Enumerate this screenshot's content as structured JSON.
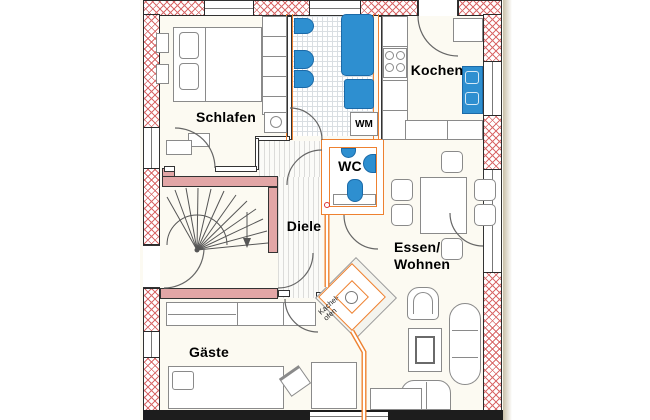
{
  "plan": {
    "type": "apartment-floor-plan",
    "rooms": [
      {
        "id": "schlafen",
        "label": "Schlafen"
      },
      {
        "id": "kochen",
        "label": "Kochen"
      },
      {
        "id": "wc",
        "label": "WC"
      },
      {
        "id": "diele",
        "label": "Diele"
      },
      {
        "id": "essen-wohnen",
        "label": "Essen/\nWohnen"
      },
      {
        "id": "gaeste",
        "label": "Gäste"
      }
    ],
    "annotations": [
      {
        "id": "wm",
        "label": "WM"
      },
      {
        "id": "kachelofen",
        "label": "Kachel-\nofen"
      }
    ],
    "colors": {
      "exterior_hatch": "#d96a6a",
      "masonry_fill": "#e2a6a6",
      "new_wall": "#ee8130",
      "fixture": "#2e8fd0",
      "furniture_line": "#8a8a8a",
      "paper": "#fcfaf2",
      "wall_line": "#2a2a2a"
    }
  }
}
